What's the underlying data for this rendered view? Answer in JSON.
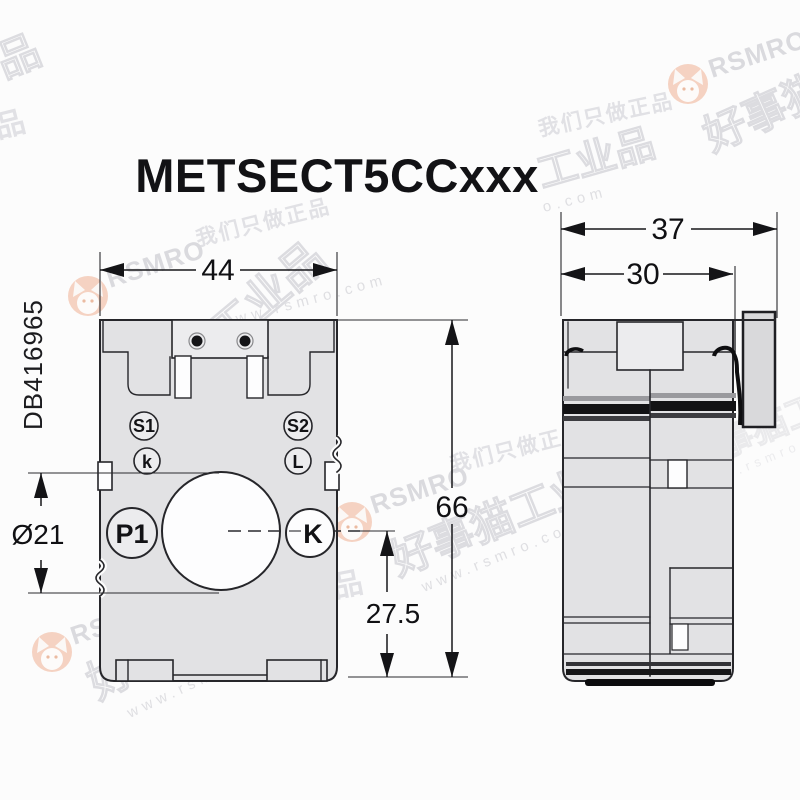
{
  "page": {
    "title": "METSECT5CCxxx",
    "doc_code": "DB416965"
  },
  "front_view": {
    "dim_width_mm": "44",
    "dim_height_mm": "66",
    "dim_axis_height_mm": "27.5",
    "dim_hole_diameter": "Ø21",
    "terminals": {
      "s1": "S1",
      "k": "k",
      "s2": "S2",
      "l": "L"
    },
    "primary_labels": {
      "p1": "P1",
      "k": "K"
    }
  },
  "side_view": {
    "dim_depth_overall_mm": "37",
    "dim_depth_body_mm": "30"
  },
  "watermark": {
    "brand": "RSMRO",
    "brand_cn": "好事猫工业品",
    "url": "www.rsmro.com",
    "url_fragment": "o.com",
    "slogan": "我们只做正品",
    "fragment_cn": "工业品",
    "fragment_char": "品"
  },
  "colors": {
    "line": "#26262a",
    "body_fill": "#e2e2e4",
    "logo_orange": "#eb9a72",
    "watermark_gray": "#bfbfc6"
  }
}
